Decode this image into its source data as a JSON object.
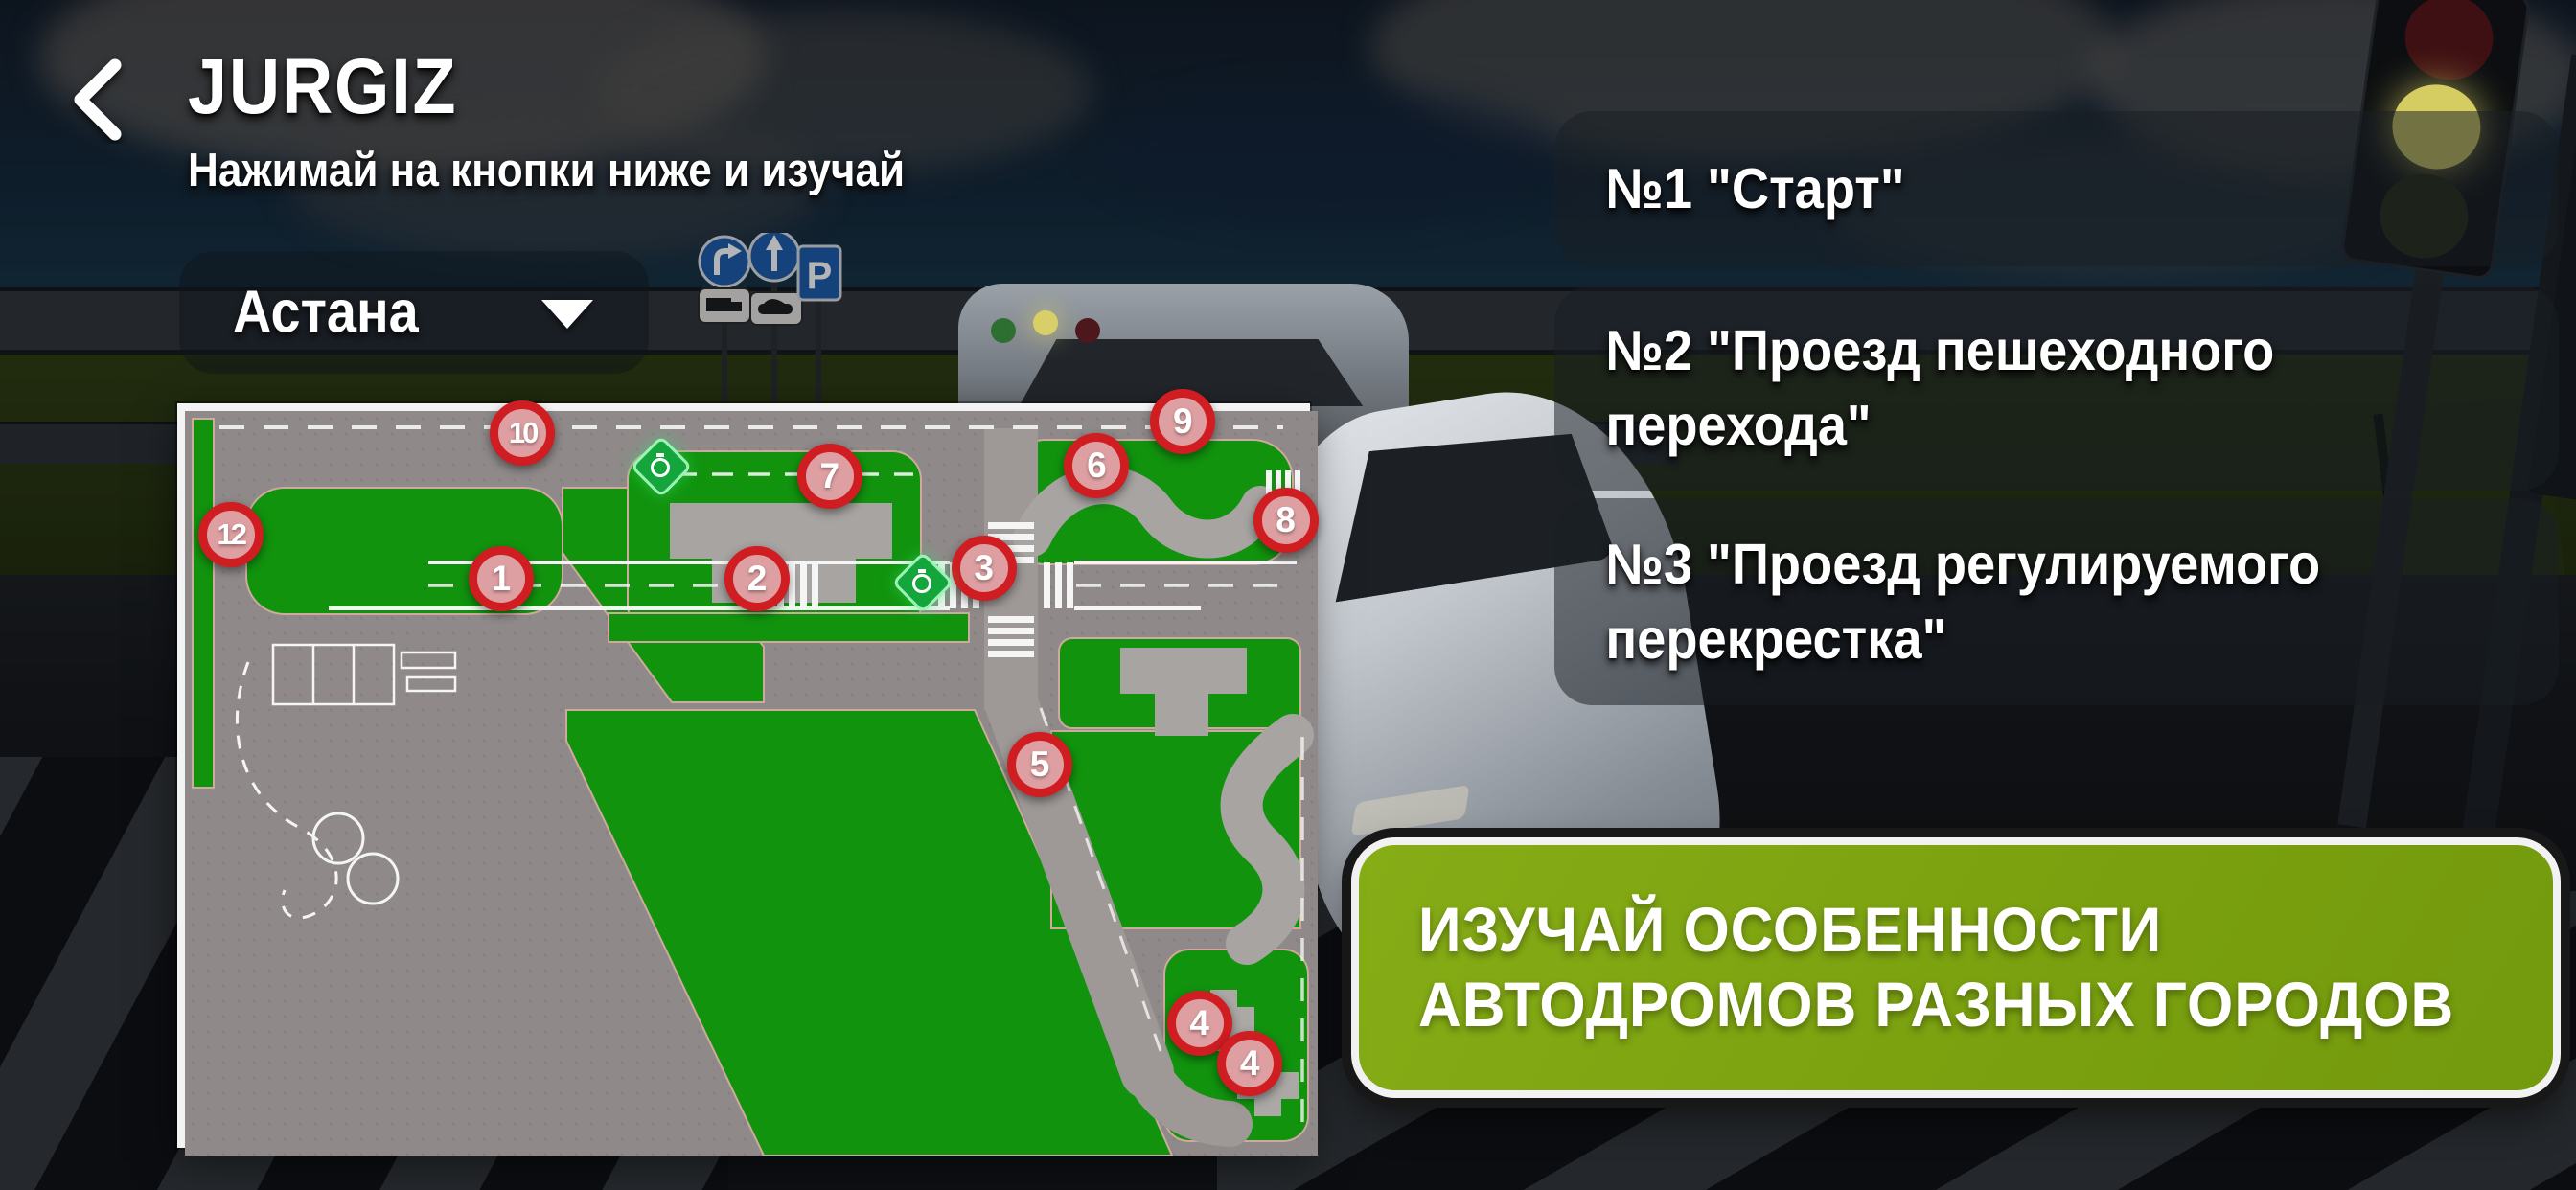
{
  "header": {
    "title": "JURGIZ",
    "subtitle": "Нажимай на кнопки ниже и изучай"
  },
  "city_dropdown": {
    "selected_city": "Астана"
  },
  "exercises": [
    {
      "label": "№1 \"Старт\""
    },
    {
      "label": "№2 \"Проезд пешеходного перехода\""
    },
    {
      "label": "№3 \"Проезд регулируемого перекрестка\""
    }
  ],
  "cta": {
    "line1": "ИЗУЧАЙ ОСОБЕННОСТИ",
    "line2": "АВТОДРОМОВ РАЗНЫХ ГОРОДОВ"
  },
  "map": {
    "markers": [
      {
        "label": "1",
        "x": 28.3,
        "y": 23.0
      },
      {
        "label": "2",
        "x": 51.2,
        "y": 23.0
      },
      {
        "label": "3",
        "x": 71.5,
        "y": 21.5
      },
      {
        "label": "4",
        "x": 90.8,
        "y": 84.0
      },
      {
        "label": "4",
        "x": 95.3,
        "y": 89.5
      },
      {
        "label": "5",
        "x": 76.5,
        "y": 48.5
      },
      {
        "label": "6",
        "x": 81.6,
        "y": 7.5
      },
      {
        "label": "7",
        "x": 57.7,
        "y": 9.0
      },
      {
        "label": "8",
        "x": 98.5,
        "y": 15.0
      },
      {
        "label": "9",
        "x": 89.3,
        "y": 1.5
      },
      {
        "label": "10",
        "x": 30.2,
        "y": 3.0
      },
      {
        "label": "12",
        "x": 4.1,
        "y": 17.0
      }
    ],
    "timer_icons": [
      {
        "x": 42.6,
        "y": 7.6
      },
      {
        "x": 66.0,
        "y": 23.5
      }
    ]
  },
  "colors": {
    "cta_green": "#7da211",
    "marker_ring": "#cf1d22",
    "marker_fill": "#dd9fa1",
    "map_green": "#11930e",
    "map_gray": "#8f8a89",
    "timer_green": "#14a53c"
  }
}
